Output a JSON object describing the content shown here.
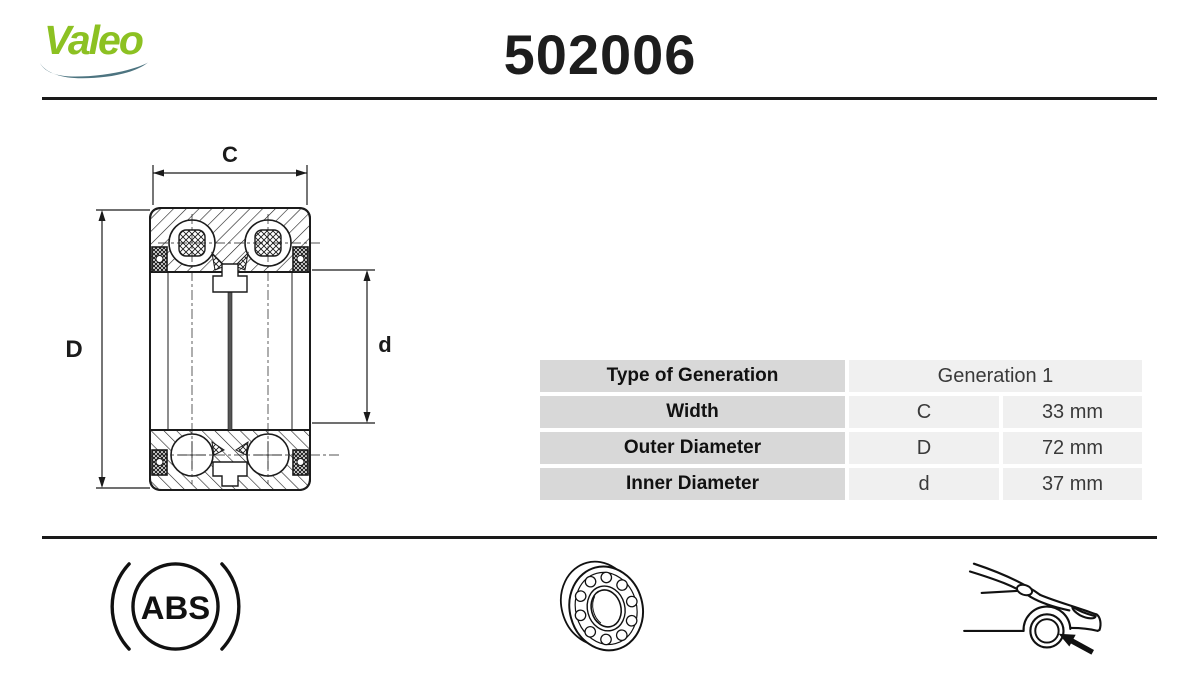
{
  "header": {
    "brand": "Valeo",
    "part_number": "502006"
  },
  "diagram": {
    "labels": {
      "width_symbol": "C",
      "outer_diameter_symbol": "D",
      "inner_diameter_symbol": "d"
    }
  },
  "spec_table": {
    "rows": [
      {
        "label": "Type of Generation",
        "value": "Generation 1"
      },
      {
        "label": "Width",
        "symbol": "C",
        "value": "33 mm"
      },
      {
        "label": "Outer Diameter",
        "symbol": "D",
        "value": "72 mm"
      },
      {
        "label": "Inner Diameter",
        "symbol": "d",
        "value": "37 mm"
      }
    ]
  },
  "footer": {
    "abs_label": "ABS",
    "icons": [
      "abs-wheel-speed-icon",
      "ball-bearing-icon",
      "car-front-wheel-icon"
    ]
  },
  "colors": {
    "brand_green": "#8cc122",
    "swoosh_teal": "#4d7480",
    "table_key_bg": "#d8d8d8",
    "table_value_bg": "#f0f0f0",
    "line_black": "#1a1a1a"
  }
}
